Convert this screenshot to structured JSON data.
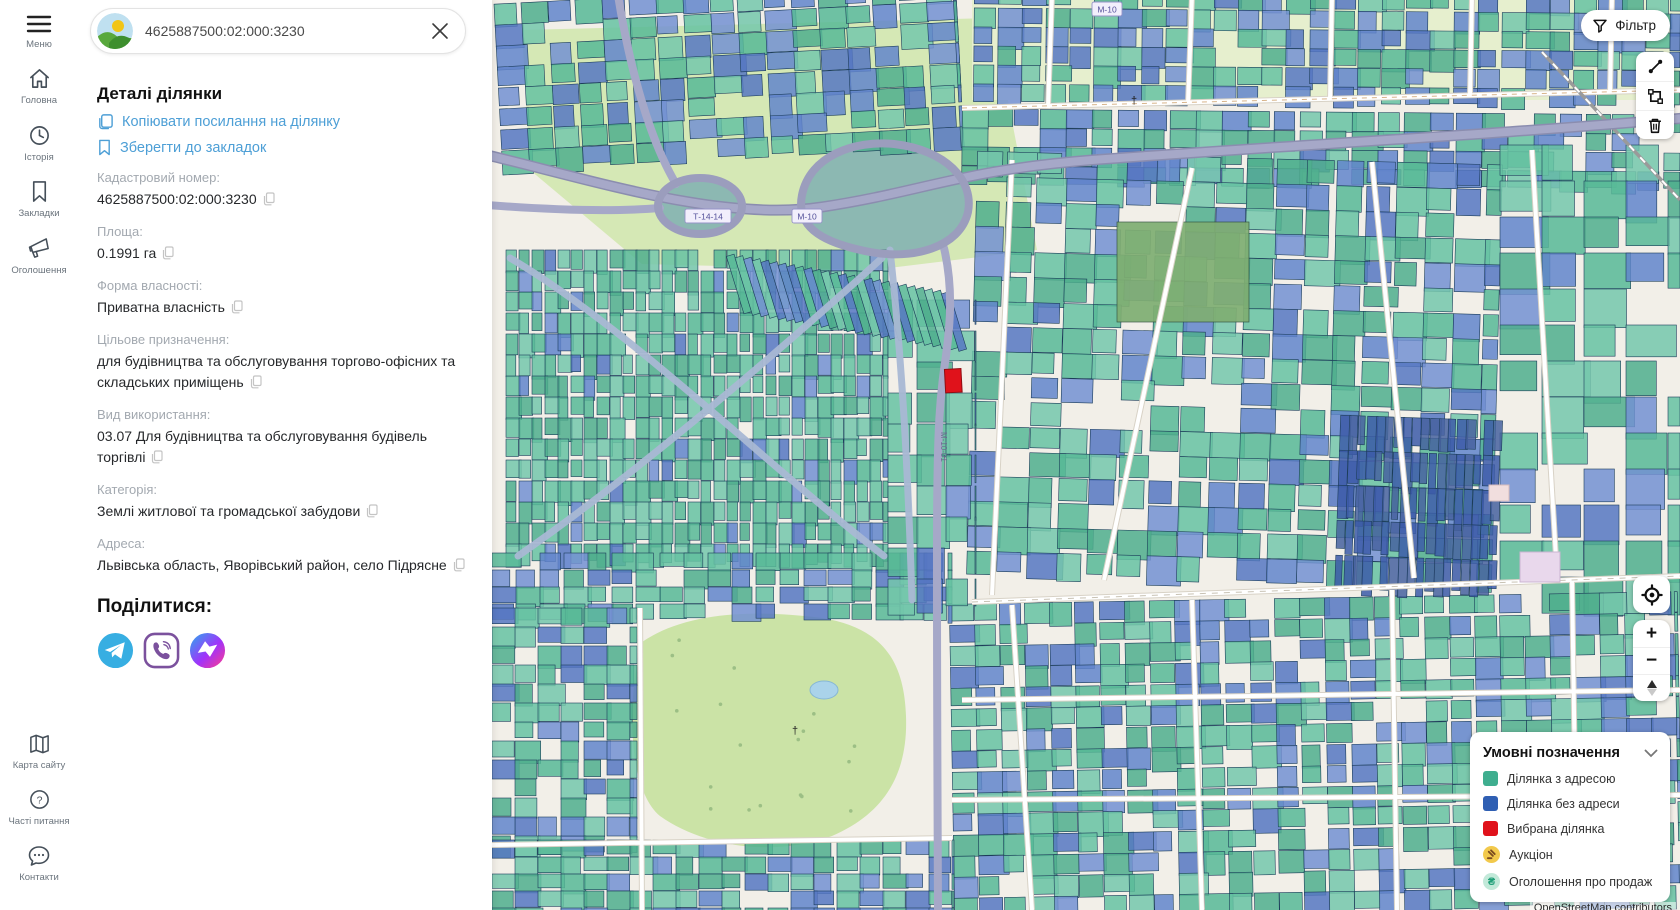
{
  "sidebar": {
    "items_top": [
      {
        "label": "Меню"
      },
      {
        "label": "Головна"
      },
      {
        "label": "Історія"
      },
      {
        "label": "Закладки"
      },
      {
        "label": "Оголошення"
      }
    ],
    "items_bottom": [
      {
        "label": "Карта сайту"
      },
      {
        "label": "Часті питання"
      },
      {
        "label": "Контакти"
      }
    ]
  },
  "search": {
    "value": "4625887500:02:000:3230"
  },
  "details": {
    "title": "Деталі ділянки",
    "actions": [
      {
        "label": "Копіювати посилання на ділянку"
      },
      {
        "label": "Зберегти до закладок"
      }
    ],
    "fields": [
      {
        "label": "Кадастровий номер:",
        "value": "4625887500:02:000:3230"
      },
      {
        "label": "Площа:",
        "value": "0.1991 га"
      },
      {
        "label": "Форма власності:",
        "value": "Приватна власність"
      },
      {
        "label": "Цільове призначення:",
        "value": "для будівництва та обслуговування торгово-офісних та складських приміщень"
      },
      {
        "label": "Вид використання:",
        "value": "03.07 Для будівництва та обслуговування будівель торгівлі"
      },
      {
        "label": "Категорія:",
        "value": "Землі житлової та громадської забудови"
      },
      {
        "label": "Адреса:",
        "value": "Львівська область, Яворівський район, село Підрясне"
      }
    ],
    "share_title": "Поділитися:",
    "share_networks": [
      "Telegram",
      "Viber",
      "Messenger"
    ]
  },
  "map": {
    "filter_label": "Фільтр",
    "zoom_in": "+",
    "zoom_out": "−",
    "shields": {
      "t1414": "Т-14-14",
      "m10": "М-10",
      "m10b": "М-10",
      "m10ring": "М-10-01"
    },
    "attribution": "OpenStreetMap contributors",
    "legend": {
      "title": "Умовні позначення",
      "sale_glyph": "₴",
      "items": [
        {
          "label": "Ділянка з адресою",
          "color": "#3fae8f"
        },
        {
          "label": "Ділянка без адреси",
          "color": "#2f5fb3"
        },
        {
          "label": "Вибрана ділянка",
          "color": "#e0121b"
        },
        {
          "label": "Аукціон",
          "color": "#f2c94c"
        },
        {
          "label": "Оголошення про продаж",
          "color": "#c2e9d9"
        }
      ]
    },
    "colors": {
      "parcel_with_address": "#56b795",
      "parcel_no_address": "#6285cb",
      "selected_parcel": "#e0121b"
    }
  }
}
